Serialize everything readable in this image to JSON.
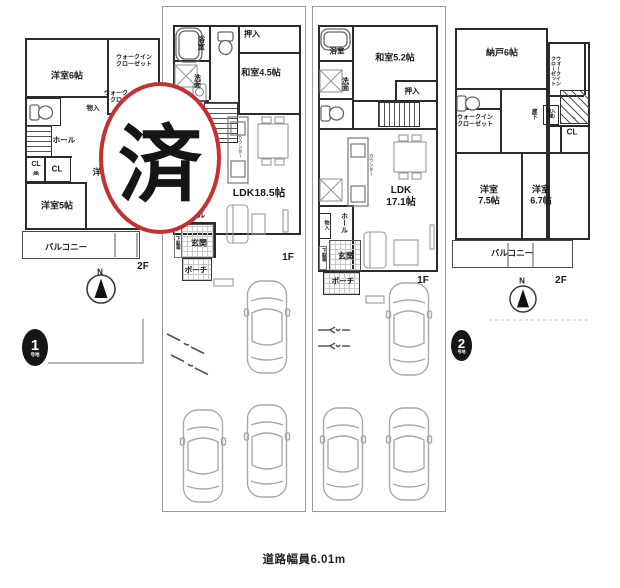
{
  "colors": {
    "stamp_red": "#c53030",
    "badge_black": "#161616",
    "wall": "#2b2b2b"
  },
  "stamp": {
    "label": "済"
  },
  "road": {
    "label": "道路幅員6.01m"
  },
  "lot1": {
    "badge": {
      "number": "1",
      "suffix": "号地"
    },
    "f1": {
      "floor": "1F",
      "bath": "浴室",
      "oshiire": "押入",
      "washitsu": "和室4.5帖",
      "senmen": "洗面",
      "counter": "カウンター",
      "ldk": "LDK18.5帖",
      "hall": "ホール",
      "getabako": "下駄箱",
      "genkan": "玄関",
      "porch": "ポーチ"
    },
    "f2": {
      "floor": "2F",
      "north": "N",
      "yoshitsu6": "洋室6帖",
      "wic1": "ウォークイン\nクローゼット",
      "wic2": "ウォーク\nクロ",
      "monoire": "物入",
      "hall": "ホール",
      "cl1": "CL",
      "cl1_sub": "(棚)",
      "cl2": "CL",
      "yo_fragment": "洋",
      "yoshitsu5": "洋室5帖",
      "balcony": "バルコニー"
    }
  },
  "lot2": {
    "badge": {
      "number": "2",
      "suffix": "号地"
    },
    "f1": {
      "floor": "1F",
      "bath": "浴室",
      "washitsu": "和室5.2帖",
      "senmen": "洗面",
      "oshiire": "押入",
      "counter": "カウンター",
      "ldk": "LDK\n17.1帖",
      "monoire": "物入",
      "hall": "ホール",
      "getabako": "下駄箱",
      "genkan": "玄関",
      "porch": "ポーチ"
    },
    "f2": {
      "floor": "2F",
      "north": "N",
      "nando": "納戸6帖",
      "wic_right": "ウォークイン\nクローゼット",
      "rouka": "廊下",
      "monoire": "物入\n(棚)",
      "wic_left": "ウォークイン\nクローゼット",
      "cl": "CL",
      "yoshitsu75": "洋室\n7.5帖",
      "yoshitsu67": "洋室\n6.7帖",
      "balcony": "バルコニー",
      "tick": "、"
    }
  }
}
